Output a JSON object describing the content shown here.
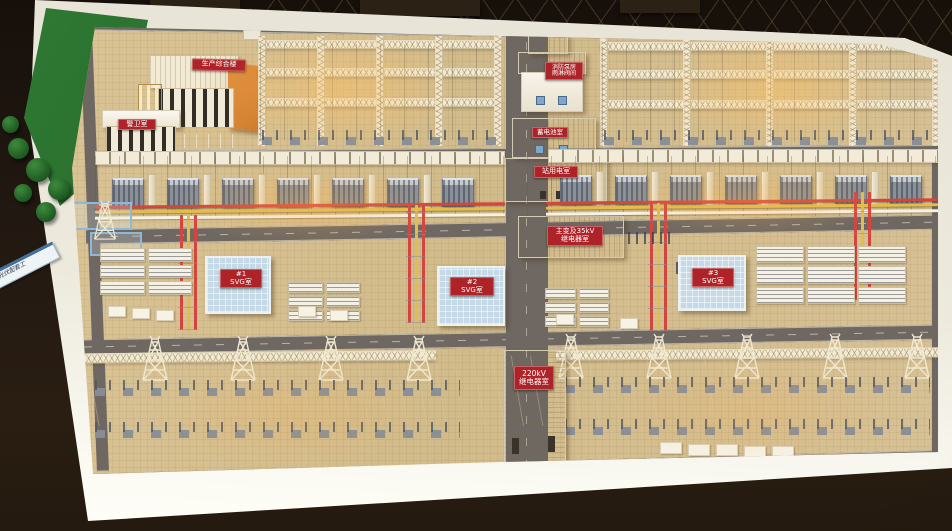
{
  "model": {
    "signs": {
      "admin_building": {
        "label": "生产综合楼"
      },
      "guard_room": {
        "label": "警卫室"
      },
      "site_plaque": {
        "label": "光伏配套工"
      },
      "pump_house": {
        "line1": "消防泵房",
        "line2": "雨淋阀间"
      },
      "battery_room": {
        "label": "蓄电池室"
      },
      "station_service_room": {
        "label": "站用电室"
      },
      "main_transformer_relay_room": {
        "line1": "主变及35kV",
        "line2": "继电器室"
      },
      "svg_room_1": {
        "line1": "#1",
        "line2": "SVG室"
      },
      "svg_room_2": {
        "line1": "#2",
        "line2": "SVG室"
      },
      "svg_room_3": {
        "line1": "#3",
        "line2": "SVG室"
      },
      "relay_room_220kv": {
        "line1": "220kV",
        "line2": "继电器室"
      }
    },
    "colors": {
      "sign_red": "#ae2328",
      "sign_text": "#ffffff",
      "busbar_red": "#d4453e",
      "busbar_yellow": "#e3bd4c",
      "grass_green": "#2e6b2d",
      "table_white": "#f0eee4",
      "base_cream": "#ead_fc4",
      "road_gray": "#6f6862",
      "glow_warm": "#ffb85e",
      "svg_roof_blue": "#c6d9e6",
      "admin_roof_orange": "#dd8838"
    }
  }
}
